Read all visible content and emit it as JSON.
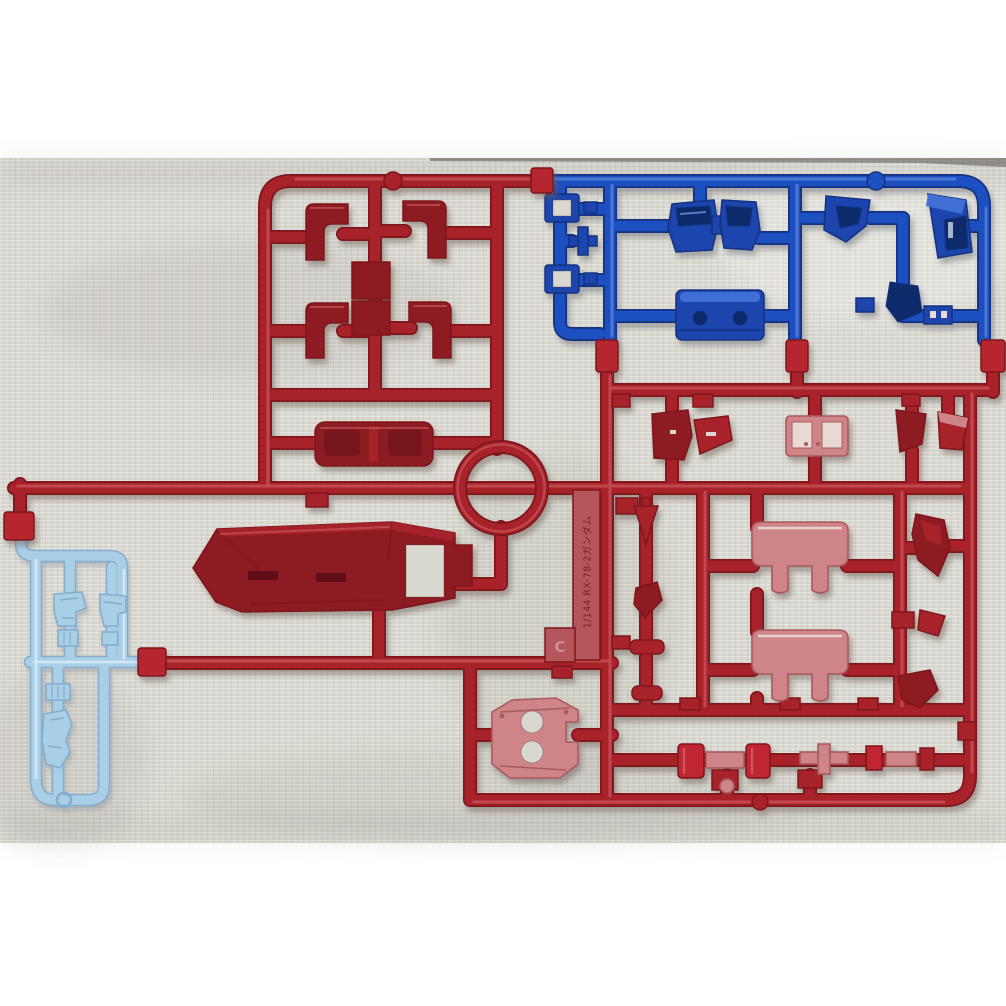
{
  "scene": {
    "type": "photograph",
    "subject": "Injection-molded plastic model kit runner (sprue) photographed on white fabric",
    "letterbox": "white bars above and below the photo"
  },
  "colors": {
    "pageBg": "#ffffff",
    "fabric": "#d9d8d0",
    "edgeDark": "#4a453f",
    "redUnder": "#7e151c",
    "redMain": "#a8242c",
    "redHi": "#d4676c",
    "redBright": "#bf2830",
    "redPartDark": "#8c1a21",
    "redPartDeep": "#5f0e13",
    "pink": "#cf8588",
    "pinkLight": "#e8d9d5",
    "pinkEdge": "#a85a5e",
    "clamp": "#b5282e",
    "tagRed": "#b5565b",
    "embossD": "#731218",
    "embossL": "#c98f92",
    "blueUnder": "#12337f",
    "blueMain": "#1e4fc0",
    "blueHi": "#6b91e0",
    "bluePart": "#1a45ae",
    "blueDark": "#0d2a6b",
    "blueTop": "#3f6ed2",
    "lbUnder": "#84aecd",
    "lbMain": "#a9cfe6",
    "lbHi": "#ddeef8"
  },
  "tag": {
    "molded_text": "1/144 RX-78-2ガンダム",
    "gate_letter": "C"
  },
  "sprues": {
    "red": {
      "color_name": "dark red",
      "parts": [
        "chest-armor-plate",
        "core-vehicle",
        "waist-ring",
        "ankle-guards",
        "helmet-pieces",
        "chest-vent",
        "skirt-armor",
        "backpack-plate",
        "thruster-cylinders",
        "blade-piece"
      ]
    },
    "blue": {
      "color_name": "blue",
      "parts": [
        "core-block",
        "chest-ducts",
        "square-frames",
        "cross-joint",
        "angled-brackets",
        "trapezoid-housing"
      ]
    },
    "light_blue": {
      "color_name": "light blue",
      "parts": [
        "foot-pieces",
        "ankle-blocks",
        "ridged-blocks",
        "heel-piece"
      ]
    }
  }
}
